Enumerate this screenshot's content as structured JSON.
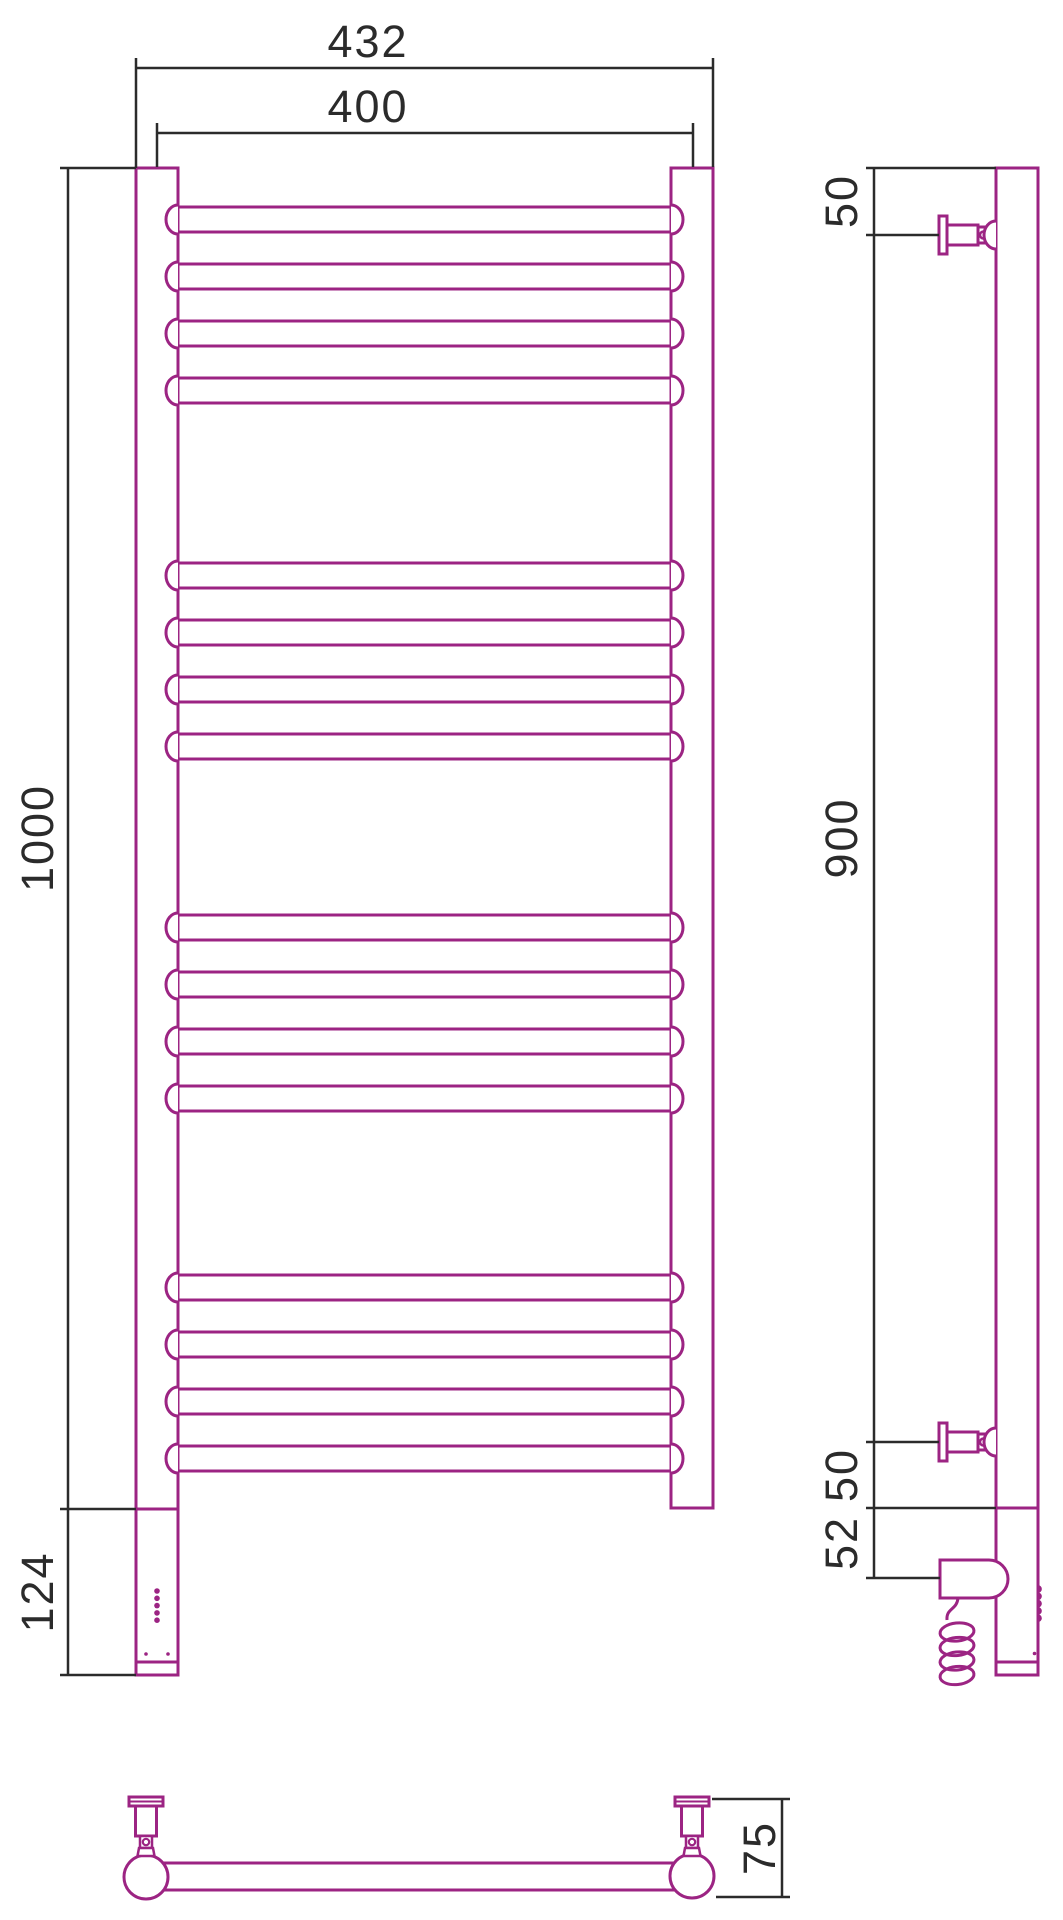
{
  "drawing": {
    "kind": "heated towel rail technical drawing, three views",
    "outline_color": "#9C2483",
    "dimension_color": "#2B2B2B",
    "front_view": {
      "dimensions": {
        "overall_width": "432",
        "center_width": "400",
        "body_height": "1000",
        "heater_section_height": "124"
      },
      "rung_groups": [
        4,
        4,
        4,
        4
      ],
      "indicator_dots": 5,
      "base_dots": 2
    },
    "side_view": {
      "dimensions": {
        "top_to_bracket": "50",
        "bracket_to_bracket": "900",
        "bracket_to_tube_end": "50",
        "tube_end_to_heater_axis": "52"
      },
      "brackets": 2,
      "coil_loops": 4,
      "edge_bumps": 5
    },
    "bottom_view": {
      "dimensions": {
        "wall_to_front": "75"
      },
      "brackets": 2
    }
  }
}
